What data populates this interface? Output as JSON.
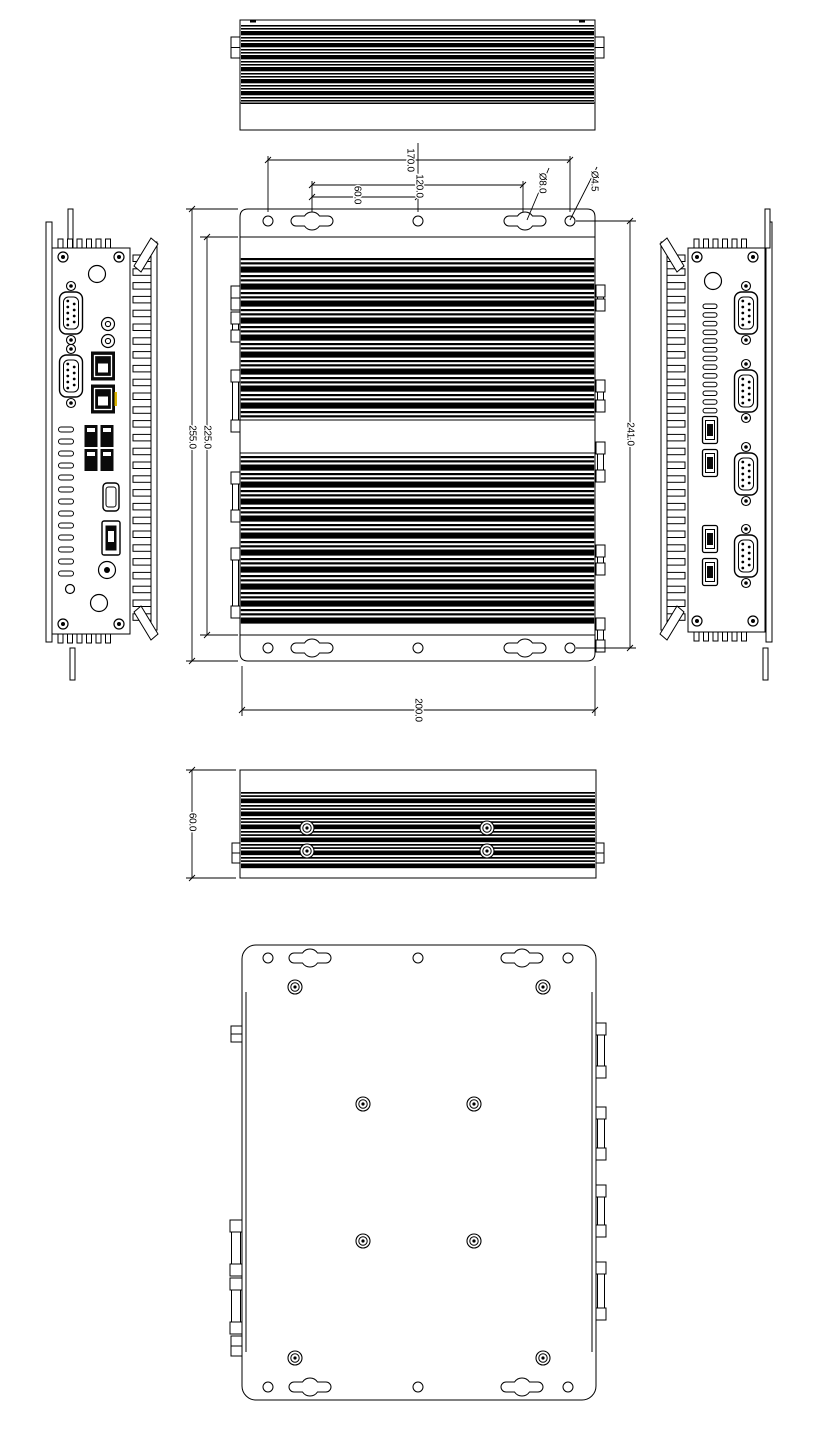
{
  "drawing": {
    "dim_labels": {
      "top_width_outer": "170.0",
      "top_width_slots": "120.0",
      "top_width_half": "60.0",
      "slot_diameter": "Ø8.0",
      "hole_diameter": "Ø4.5",
      "body_height": "225.0",
      "overall_height": "255.0",
      "mount_hole_span": "241.0",
      "bottom_width": "200.0",
      "side_height": "60.0"
    },
    "colors": {
      "line": "#000000",
      "background": "#ffffff",
      "highlight": "#d9b300"
    }
  }
}
